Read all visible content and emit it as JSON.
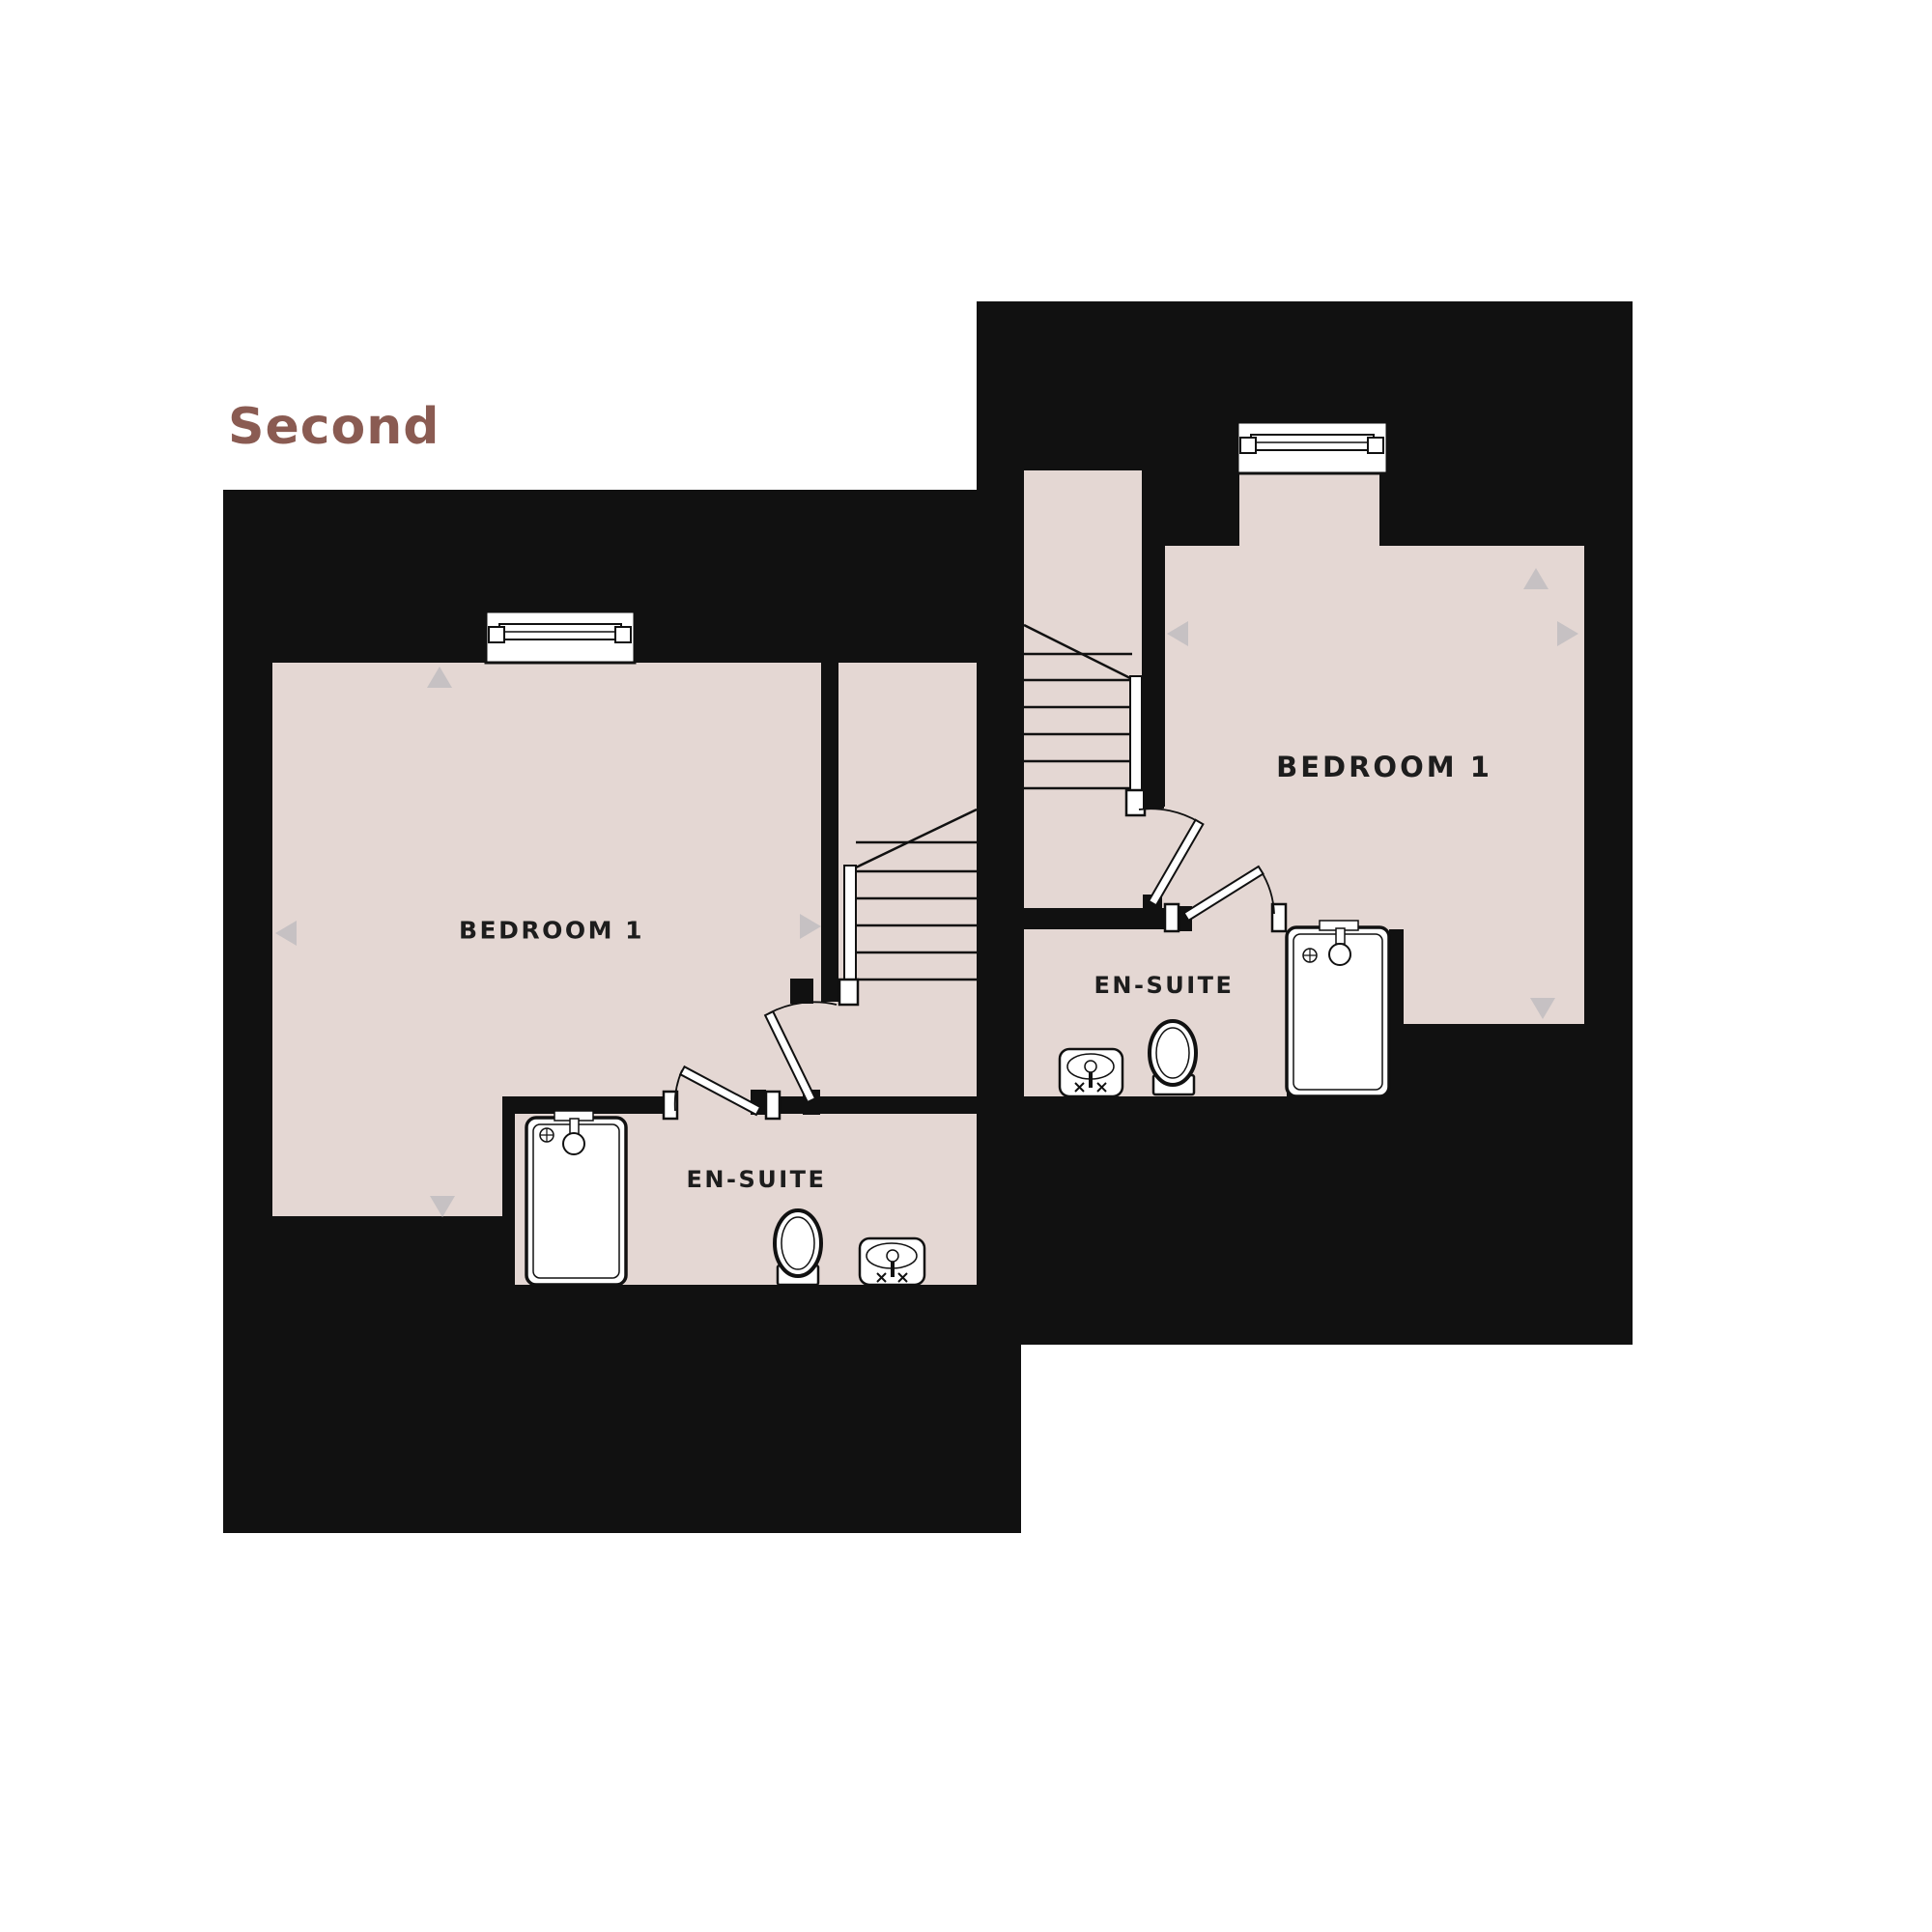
{
  "title": "Second",
  "colors": {
    "ink": "#111111",
    "room": "#e4d7d3",
    "arrow": "#c6c1c3",
    "title": "#8a5b52",
    "text": "#1d1d1d",
    "background": "#ffffff"
  },
  "units": {
    "left": {
      "bedroom_label": "BEDROOM 1",
      "ensuite_label": "EN-SUITE"
    },
    "right": {
      "bedroom_label": "BEDROOM 1",
      "ensuite_label": "EN-SUITE"
    }
  }
}
